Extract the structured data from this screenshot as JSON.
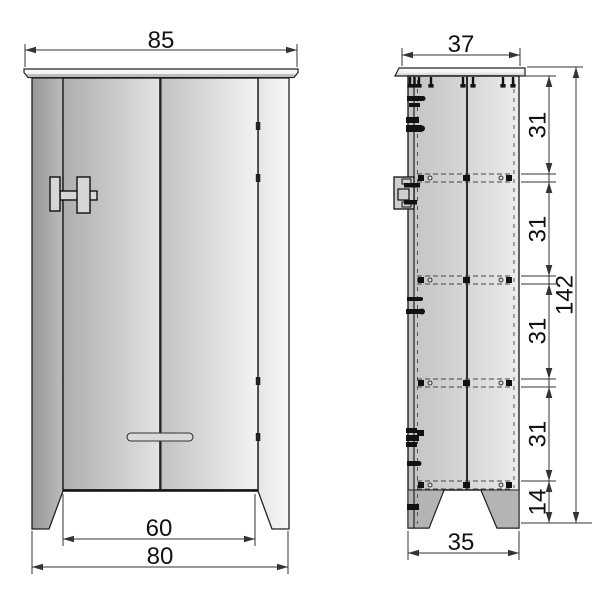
{
  "drawing": {
    "kind": "furniture technical drawing, front and side elevation of a two-door cabinet"
  },
  "front_view": {
    "dims": {
      "top_width": "85",
      "opening_width": "60",
      "base_width": "80"
    }
  },
  "side_view": {
    "dims": {
      "top_depth": "37",
      "base_depth": "35",
      "total_height": "142",
      "leg_height": "14",
      "segments": {
        "s1": "31",
        "s2": "31",
        "s3": "31",
        "s4": "31"
      }
    }
  },
  "colors": {
    "object_line": "#1a1a1a",
    "dimension_line": "#333333",
    "panel_dark": "#9e9e9e",
    "panel_light": "#f2f2f2",
    "hardware": "#111111",
    "background": "#ffffff"
  }
}
